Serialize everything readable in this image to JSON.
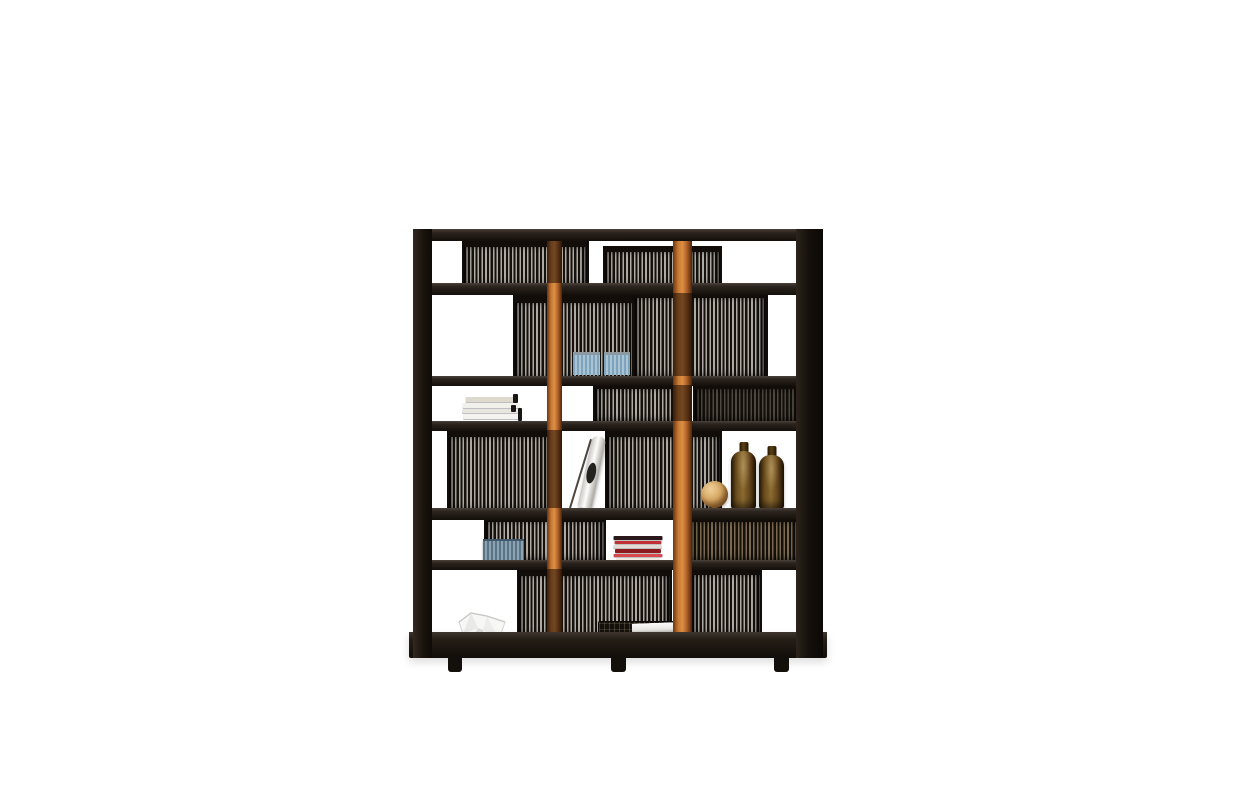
{
  "canvas": {
    "width": 1235,
    "height": 800,
    "background": "#ffffff"
  },
  "subject": "black-wood-bookcase-product-photo",
  "palette": {
    "frame_black": "#1c1611",
    "accent_orange": "#c87a33",
    "spine_light": "#aeaaa3",
    "spine_dark": "#16110d",
    "bottle_amber": "#8a6a30",
    "cd_blue": "#a9c4d4",
    "book_red": "#c03036",
    "paper_white": "#f7f7f6"
  },
  "scene": {
    "panels": [
      {
        "name": "left-side-panel",
        "x": 413,
        "y": 229,
        "w": 19,
        "h": 429,
        "side": "left"
      },
      {
        "name": "right-side-panel",
        "x": 796,
        "y": 229,
        "w": 27,
        "h": 429,
        "side": "right"
      }
    ],
    "boards": [
      {
        "name": "top-board",
        "x": 413,
        "y": 229,
        "w": 410,
        "h": 12,
        "front": true,
        "bottom": false
      },
      {
        "name": "shelf-board-2",
        "x": 413,
        "y": 283,
        "w": 410,
        "h": 12,
        "front": false,
        "bottom": false
      },
      {
        "name": "shelf-board-3",
        "x": 413,
        "y": 376,
        "w": 410,
        "h": 10,
        "front": false,
        "bottom": false
      },
      {
        "name": "shelf-board-4",
        "x": 413,
        "y": 421,
        "w": 410,
        "h": 10,
        "front": false,
        "bottom": false
      },
      {
        "name": "shelf-board-5",
        "x": 413,
        "y": 508,
        "w": 410,
        "h": 12,
        "front": false,
        "bottom": false
      },
      {
        "name": "shelf-board-6",
        "x": 413,
        "y": 560,
        "w": 410,
        "h": 10,
        "front": false,
        "bottom": false
      },
      {
        "name": "bottom-board",
        "x": 409,
        "y": 632,
        "w": 418,
        "h": 26,
        "front": true,
        "bottom": true
      }
    ],
    "posts": [
      {
        "name": "orange-post-left",
        "x": 547,
        "y": 233,
        "w": 15,
        "h": 407,
        "shades": [
          {
            "top": 0,
            "h": 50
          },
          {
            "top": 197,
            "h": 78
          },
          {
            "top": 336,
            "h": 71
          }
        ]
      },
      {
        "name": "orange-post-right",
        "x": 673,
        "y": 233,
        "w": 19,
        "h": 407,
        "shades": [
          {
            "top": 60,
            "h": 83
          },
          {
            "top": 152,
            "h": 36
          }
        ]
      }
    ],
    "feet": [
      {
        "name": "foot-left",
        "x": 448,
        "y": 656,
        "w": 14,
        "h": 16
      },
      {
        "name": "foot-center",
        "x": 611,
        "y": 656,
        "w": 15,
        "h": 16
      },
      {
        "name": "foot-right",
        "x": 774,
        "y": 656,
        "w": 15,
        "h": 16
      }
    ],
    "cd_rows": [
      {
        "name": "cd-row-1-left",
        "x": 462,
        "y": 241,
        "w": 123,
        "h": 44,
        "rail": 6,
        "variant": ""
      },
      {
        "name": "cd-row-1-center",
        "x": 603,
        "y": 246,
        "w": 115,
        "h": 39,
        "rail": 6,
        "variant": ""
      },
      {
        "name": "cd-row-2-left",
        "x": 513,
        "y": 295,
        "w": 119,
        "h": 81,
        "rail": 8,
        "variant": ""
      },
      {
        "name": "cd-row-2-right",
        "x": 632,
        "y": 292,
        "w": 130,
        "h": 84,
        "rail": 6,
        "variant": "framed"
      },
      {
        "name": "cd-row-3-center",
        "x": 593,
        "y": 384,
        "w": 85,
        "h": 37,
        "rail": 5,
        "variant": ""
      },
      {
        "name": "cd-row-3-right",
        "x": 693,
        "y": 384,
        "w": 104,
        "h": 37,
        "rail": 5,
        "variant": "dim"
      },
      {
        "name": "cd-row-4-left",
        "x": 447,
        "y": 430,
        "w": 101,
        "h": 78,
        "rail": 7,
        "variant": ""
      },
      {
        "name": "cd-row-4-center",
        "x": 605,
        "y": 430,
        "w": 113,
        "h": 78,
        "rail": 7,
        "variant": ""
      },
      {
        "name": "cd-row-5-left",
        "x": 484,
        "y": 517,
        "w": 118,
        "h": 43,
        "rail": 5,
        "variant": ""
      },
      {
        "name": "cd-row-5-right",
        "x": 688,
        "y": 517,
        "w": 109,
        "h": 43,
        "rail": 5,
        "variant": "warm"
      },
      {
        "name": "cd-row-6-left",
        "x": 517,
        "y": 569,
        "w": 151,
        "h": 66,
        "rail": 7,
        "variant": ""
      },
      {
        "name": "cd-row-6-center",
        "x": 690,
        "y": 569,
        "w": 68,
        "h": 66,
        "rail": 6,
        "variant": ""
      }
    ],
    "objects": [
      {
        "type": "book-stack-white",
        "name": "white-book-stack",
        "x": 462,
        "y": 392,
        "w": 58,
        "h": 28,
        "strips": [
          {
            "c": "#f5f3ef",
            "h": 6,
            "wp": 96
          },
          {
            "c": "#e9e6df",
            "h": 5,
            "wp": 100
          },
          {
            "c": "#f2f0ea",
            "h": 6,
            "wp": 98
          },
          {
            "c": "#ded9cd",
            "h": 6,
            "wp": 88
          }
        ]
      },
      {
        "type": "leaning-bottle",
        "name": "leaning-white-object",
        "x": 566,
        "y": 434,
        "w": 30,
        "h": 75
      },
      {
        "type": "cd-cases-blue",
        "name": "blue-cd-cases-a",
        "x": 573,
        "y": 352,
        "w": 27,
        "h": 20
      },
      {
        "type": "cd-cases-blue",
        "name": "blue-cd-cases-b",
        "x": 604,
        "y": 352,
        "w": 26,
        "h": 20
      },
      {
        "type": "wood-sphere",
        "name": "wooden-sphere",
        "x": 701,
        "y": 481,
        "w": 27,
        "h": 27
      },
      {
        "type": "amber-bottle",
        "name": "amber-bottle-1",
        "x": 731,
        "y": 442,
        "w": 25,
        "h": 67
      },
      {
        "type": "amber-bottle",
        "name": "amber-bottle-2",
        "x": 759,
        "y": 446,
        "w": 25,
        "h": 63
      },
      {
        "type": "cd-stack-blue",
        "name": "blue-cd-stack",
        "x": 483,
        "y": 539,
        "w": 41,
        "h": 23
      },
      {
        "type": "book-stack-red",
        "name": "red-book-stack",
        "x": 613,
        "y": 536,
        "w": 49,
        "h": 26,
        "strips": [
          {
            "c": "#efe8e0",
            "h": 4,
            "wp": 90
          },
          {
            "c": "#d8494d",
            "h": 4,
            "wp": 100
          },
          {
            "c": "#8c1b20",
            "h": 5,
            "wp": 94
          },
          {
            "c": "#e4dcd4",
            "h": 4,
            "wp": 102
          },
          {
            "c": "#c03036",
            "h": 4,
            "wp": 96
          },
          {
            "c": "#2b181a",
            "h": 5,
            "wp": 100
          }
        ]
      },
      {
        "type": "paper-bowl",
        "name": "white-paper-bowl",
        "x": 456,
        "y": 611,
        "w": 52,
        "h": 34
      },
      {
        "type": "wire-basket",
        "name": "wire-basket",
        "x": 598,
        "y": 621,
        "w": 74,
        "h": 26
      },
      {
        "type": "white-book",
        "name": "white-book-on-basket",
        "x": 632,
        "y": 623,
        "w": 42,
        "h": 12
      }
    ]
  }
}
